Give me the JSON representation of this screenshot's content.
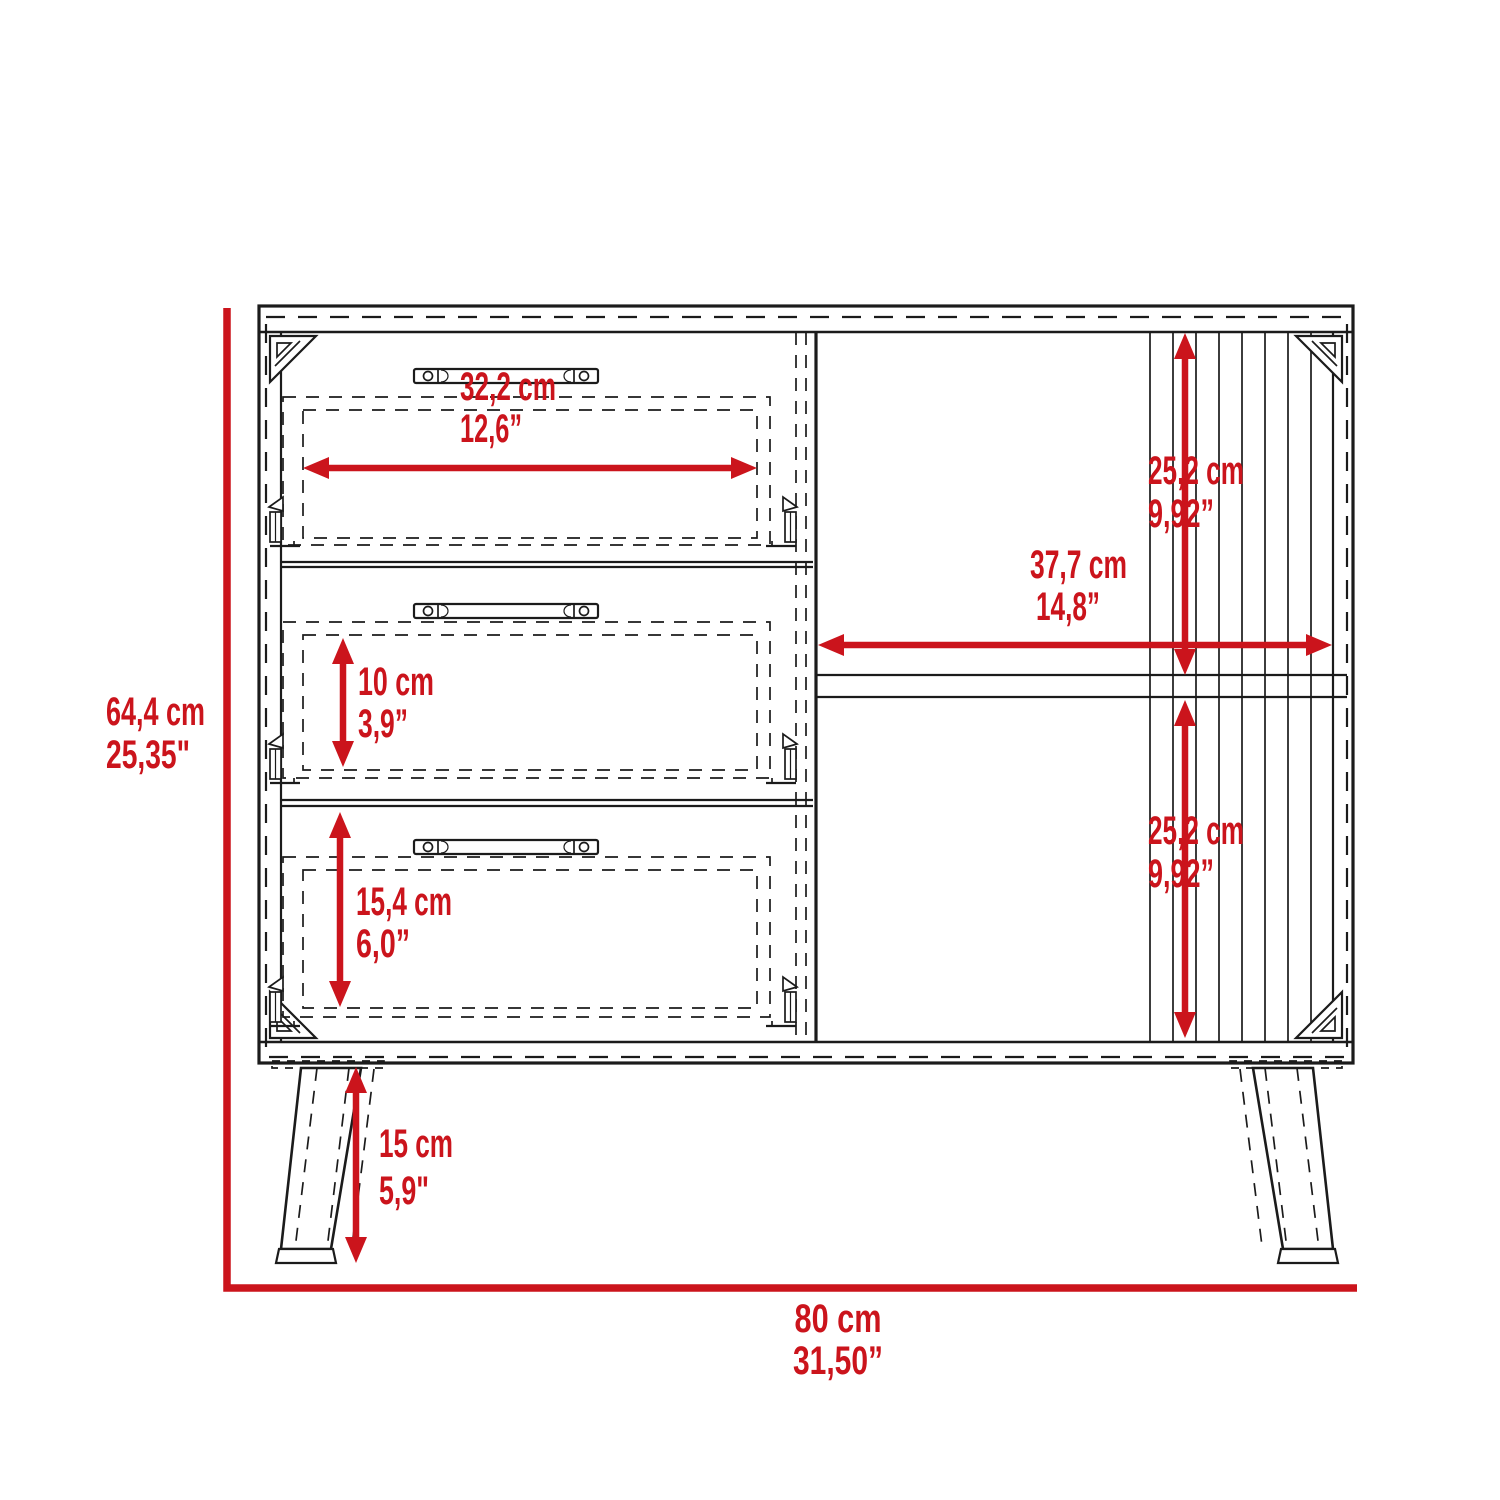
{
  "diagram": {
    "kind": "furniture-dimension-drawing",
    "subject": "3-drawer dresser with side compartment and angled legs, front view",
    "units": [
      "cm",
      "inches"
    ]
  },
  "colors": {
    "accent": "#CB141C",
    "line": "#1b1b1b",
    "background": "#ffffff"
  },
  "dims": {
    "overall_height": {
      "cm": "64,4 cm",
      "in": "25,35\""
    },
    "overall_width": {
      "cm": "80 cm",
      "in": "31,50”"
    },
    "drawer_opening_width": {
      "cm": "32,2 cm",
      "in": "12,6”"
    },
    "middle_drawer_height": {
      "cm": "10 cm",
      "in": "3,9”"
    },
    "bottom_drawer_height": {
      "cm": "15,4 cm",
      "in": "6,0”"
    },
    "side_compartment_width": {
      "cm": "37,7 cm",
      "in": "14,8”"
    },
    "upper_compartment_height": {
      "cm": "25,2 cm",
      "in": "9,92”"
    },
    "lower_compartment_height": {
      "cm": "25,2 cm",
      "in": "9,92”"
    },
    "leg_height": {
      "cm": "15 cm",
      "in": "5,9\""
    }
  }
}
